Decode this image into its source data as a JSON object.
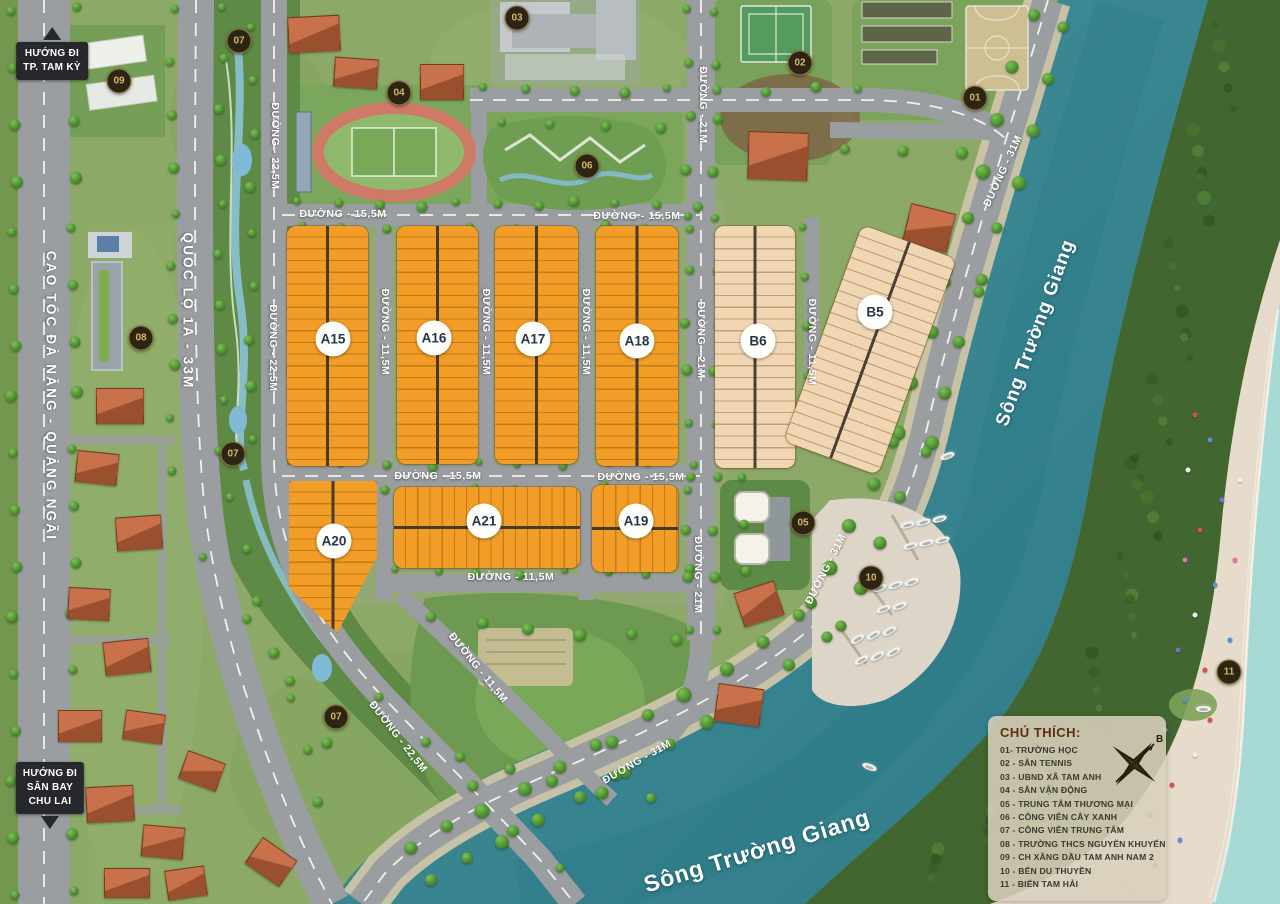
{
  "palette": {
    "base": "#8ca968",
    "scrub": "#74974f",
    "road": "#9b9ea1",
    "roadTan": "#cfc5a8",
    "river1": "#44929c",
    "river2": "#2e7a87",
    "forest": "#41662f",
    "beach": "#e7dccb",
    "sea": "#a7d9d5",
    "parkDark": "#5f8a46",
    "lawn": "#7ba75c",
    "orange": "#f29d27",
    "beige": "#f1d6b4",
    "markerBg": "#2c2414",
    "markerGold": "#d9b761",
    "badgeText": "#253648",
    "signBg": "#26282c"
  },
  "signs": [
    {
      "lines": "HƯỚNG ĐI\nTP. TAM KỲ",
      "x": 52,
      "y": 27,
      "arrow": "up"
    },
    {
      "lines": "HƯỚNG ĐI\nSÂN BAY\nCHU LAI",
      "x": 50,
      "y": 762,
      "arrow": "down"
    }
  ],
  "road_labels": [
    {
      "t": "CAO TỐC ĐÀ NẴNG - QUẢNG NGÃI",
      "x": 51,
      "y": 396,
      "r": 90,
      "big": true
    },
    {
      "t": "QUỐC LỘ 1A - 33M",
      "x": 188,
      "y": 311,
      "r": 90,
      "big": true
    },
    {
      "t": "ĐƯỜNG - 15,5M",
      "x": 343,
      "y": 214,
      "r": 0
    },
    {
      "t": "ĐƯỜNG - 15,5M",
      "x": 637,
      "y": 216,
      "r": 0
    },
    {
      "t": "ĐƯỜNG - 15,5M",
      "x": 438,
      "y": 476,
      "r": 0
    },
    {
      "t": "ĐƯỜNG - 15,5M",
      "x": 641,
      "y": 477,
      "r": 0
    },
    {
      "t": "ĐƯỜNG - 11,5M",
      "x": 511,
      "y": 577,
      "r": 0
    },
    {
      "t": "ĐƯỜNG - 11,5M",
      "x": 385,
      "y": 332,
      "r": 90
    },
    {
      "t": "ĐƯỜNG - 11,5M",
      "x": 486,
      "y": 332,
      "r": 90
    },
    {
      "t": "ĐƯỜNG - 11,5M",
      "x": 586,
      "y": 332,
      "r": 90
    },
    {
      "t": "ĐƯỜNG - 11,5M",
      "x": 812,
      "y": 342,
      "r": 90
    },
    {
      "t": "ĐƯỜNG - 21M",
      "x": 703,
      "y": 105,
      "r": 90
    },
    {
      "t": "ĐƯỜNG - 21M",
      "x": 701,
      "y": 340,
      "r": 90
    },
    {
      "t": "ĐƯỜNG - 21M",
      "x": 698,
      "y": 575,
      "r": 90
    },
    {
      "t": "ĐƯỜNG - 22,5M",
      "x": 275,
      "y": 146,
      "r": 90
    },
    {
      "t": "ĐƯỜNG - 22,5M",
      "x": 273,
      "y": 348,
      "r": 90
    },
    {
      "t": "ĐƯỜNG - 22,5M",
      "x": 398,
      "y": 737,
      "r": 52
    },
    {
      "t": "ĐƯỜNG - 11,5M",
      "x": 478,
      "y": 668,
      "r": 51
    },
    {
      "t": "ĐƯỜNG - 31M",
      "x": 1003,
      "y": 171,
      "r": -65
    },
    {
      "t": "ĐƯỜNG - 31M",
      "x": 826,
      "y": 569,
      "r": -63
    },
    {
      "t": "ĐƯỜNG - 31M",
      "x": 637,
      "y": 762,
      "r": -30
    }
  ],
  "river_labels": [
    {
      "t": "Sông Trường Giang",
      "x": 1036,
      "y": 333,
      "r": -70,
      "size": 19
    },
    {
      "t": "Sông Trường Giang",
      "x": 757,
      "y": 851,
      "r": -17,
      "size": 23
    }
  ],
  "markers": [
    {
      "n": "01",
      "x": 975,
      "y": 98
    },
    {
      "n": "02",
      "x": 800,
      "y": 63
    },
    {
      "n": "03",
      "x": 517,
      "y": 18
    },
    {
      "n": "04",
      "x": 399,
      "y": 93
    },
    {
      "n": "05",
      "x": 803,
      "y": 523
    },
    {
      "n": "06",
      "x": 587,
      "y": 166
    },
    {
      "n": "07",
      "x": 239,
      "y": 41
    },
    {
      "n": "07",
      "x": 233,
      "y": 454
    },
    {
      "n": "07",
      "x": 336,
      "y": 717
    },
    {
      "n": "08",
      "x": 141,
      "y": 338
    },
    {
      "n": "09",
      "x": 119,
      "y": 81
    },
    {
      "n": "10",
      "x": 871,
      "y": 578
    },
    {
      "n": "11",
      "x": 1229,
      "y": 672
    }
  ],
  "blocks": [
    {
      "label": "A15",
      "x": 287,
      "y": 226,
      "w": 81,
      "h": 240,
      "color": "orange",
      "dir": "h",
      "badge": [
        333,
        339
      ]
    },
    {
      "label": "A16",
      "x": 397,
      "y": 226,
      "w": 81,
      "h": 238,
      "color": "orange",
      "dir": "h",
      "badge": [
        434,
        338
      ]
    },
    {
      "label": "A17",
      "x": 495,
      "y": 226,
      "w": 83,
      "h": 238,
      "color": "orange",
      "dir": "h",
      "badge": [
        533,
        339
      ]
    },
    {
      "label": "A18",
      "x": 596,
      "y": 226,
      "w": 82,
      "h": 240,
      "color": "orange",
      "dir": "h",
      "badge": [
        637,
        341
      ]
    },
    {
      "label": "B6",
      "x": 715,
      "y": 226,
      "w": 80,
      "h": 242,
      "color": "beige",
      "dir": "h",
      "badge": [
        758,
        341
      ]
    },
    {
      "label": "B5",
      "x": 820,
      "y": 235,
      "w": 100,
      "h": 230,
      "color": "beige",
      "dir": "h",
      "rot": 20,
      "badge": [
        875,
        312
      ]
    },
    {
      "label": "A20",
      "x": 289,
      "y": 481,
      "w": 88,
      "h": 152,
      "color": "orange",
      "dir": "h",
      "clip": "polygon(0 0,100% 0,100% 50%,55% 100%,0 70%)",
      "badge": [
        334,
        541
      ]
    },
    {
      "label": "A21",
      "x": 394,
      "y": 487,
      "w": 186,
      "h": 81,
      "color": "orange",
      "dir": "v",
      "badge": [
        484,
        521
      ]
    },
    {
      "label": "A19",
      "x": 592,
      "y": 485,
      "w": 86,
      "h": 87,
      "color": "orange",
      "dir": "v",
      "badge": [
        636,
        521
      ]
    }
  ],
  "legend": {
    "title": "CHÚ THÍCH:",
    "items": [
      "01- TRƯỜNG HỌC",
      "02 - SÂN TENNIS",
      "03 - UBND XÃ TAM ANH",
      "04 - SÂN VẬN ĐỘNG",
      "05 - TRUNG TÂM THƯƠNG MẠI",
      "06 - CÔNG VIÊN CÂY XANH",
      "07 - CÔNG VIÊN TRUNG TÂM",
      "08 - TRƯỜNG THCS NGUYỄN KHUYẾN",
      "09 - CH XĂNG DẦU TAM ANH NAM 2",
      "10 - BẾN DU THUYỀN",
      "11 - BIỂN TAM HẢI"
    ]
  },
  "compass": {
    "north_label": "B"
  },
  "tree_lines": [
    {
      "x1": 14,
      "y1": 14,
      "x2": 14,
      "y2": 894,
      "n": 17,
      "s": 10
    },
    {
      "x1": 74,
      "y1": 10,
      "x2": 74,
      "y2": 890,
      "n": 17,
      "s": 10
    },
    {
      "x1": 173,
      "y1": 12,
      "x2": 173,
      "y2": 470,
      "n": 10,
      "s": 9
    },
    {
      "x1": 221,
      "y1": 10,
      "x2": 221,
      "y2": 450,
      "n": 10,
      "s": 9
    },
    {
      "x1": 230,
      "y1": 500,
      "x2": 320,
      "y2": 800,
      "n": 7,
      "s": 9
    },
    {
      "x1": 252,
      "y1": 30,
      "x2": 252,
      "y2": 440,
      "n": 9,
      "s": 9
    },
    {
      "x1": 295,
      "y1": 235,
      "x2": 295,
      "y2": 455,
      "n": 6,
      "s": 9
    },
    {
      "x1": 300,
      "y1": 204,
      "x2": 695,
      "y2": 204,
      "n": 11,
      "s": 9
    },
    {
      "x1": 300,
      "y1": 228,
      "x2": 690,
      "y2": 228,
      "n": 10,
      "s": 8
    },
    {
      "x1": 300,
      "y1": 464,
      "x2": 695,
      "y2": 464,
      "n": 10,
      "s": 8
    },
    {
      "x1": 300,
      "y1": 489,
      "x2": 690,
      "y2": 489,
      "n": 10,
      "s": 8
    },
    {
      "x1": 395,
      "y1": 572,
      "x2": 690,
      "y2": 572,
      "n": 8,
      "s": 8
    },
    {
      "x1": 688,
      "y1": 12,
      "x2": 688,
      "y2": 630,
      "n": 13,
      "s": 9
    },
    {
      "x1": 716,
      "y1": 15,
      "x2": 716,
      "y2": 630,
      "n": 13,
      "s": 9
    },
    {
      "x1": 806,
      "y1": 230,
      "x2": 806,
      "y2": 420,
      "n": 5,
      "s": 8
    },
    {
      "x1": 480,
      "y1": 90,
      "x2": 860,
      "y2": 90,
      "n": 9,
      "s": 9
    },
    {
      "x1": 1032,
      "y1": 18,
      "x2": 948,
      "y2": 270,
      "n": 6,
      "s": 13
    },
    {
      "x1": 944,
      "y1": 285,
      "x2": 898,
      "y2": 430,
      "n": 4,
      "s": 13
    },
    {
      "x1": 893,
      "y1": 445,
      "x2": 810,
      "y2": 605,
      "n": 5,
      "s": 13
    },
    {
      "x1": 800,
      "y1": 618,
      "x2": 610,
      "y2": 742,
      "n": 6,
      "s": 13
    },
    {
      "x1": 598,
      "y1": 748,
      "x2": 410,
      "y2": 848,
      "n": 6,
      "s": 13
    },
    {
      "x1": 1066,
      "y1": 30,
      "x2": 982,
      "y2": 280,
      "n": 6,
      "s": 12
    },
    {
      "x1": 976,
      "y1": 295,
      "x2": 930,
      "y2": 440,
      "n": 4,
      "s": 12
    },
    {
      "x1": 924,
      "y1": 455,
      "x2": 838,
      "y2": 628,
      "n": 5,
      "s": 12
    },
    {
      "x1": 826,
      "y1": 640,
      "x2": 628,
      "y2": 772,
      "n": 6,
      "s": 12
    },
    {
      "x1": 616,
      "y1": 778,
      "x2": 428,
      "y2": 880,
      "n": 6,
      "s": 12
    },
    {
      "x1": 380,
      "y1": 700,
      "x2": 560,
      "y2": 870,
      "n": 5,
      "s": 10
    },
    {
      "x1": 205,
      "y1": 560,
      "x2": 330,
      "y2": 740,
      "n": 4,
      "s": 9
    },
    {
      "x1": 745,
      "y1": 480,
      "x2": 745,
      "y2": 570,
      "n": 3,
      "s": 9
    },
    {
      "x1": 790,
      "y1": 150,
      "x2": 960,
      "y2": 150,
      "n": 4,
      "s": 10
    },
    {
      "x1": 500,
      "y1": 125,
      "x2": 660,
      "y2": 125,
      "n": 4,
      "s": 9
    },
    {
      "x1": 430,
      "y1": 620,
      "x2": 680,
      "y2": 640,
      "n": 6,
      "s": 11
    },
    {
      "x1": 460,
      "y1": 760,
      "x2": 650,
      "y2": 800,
      "n": 5,
      "s": 11
    }
  ],
  "houses": [
    {
      "x": 288,
      "y": 16,
      "w": 50,
      "h": 34,
      "r": -3
    },
    {
      "x": 334,
      "y": 58,
      "w": 42,
      "h": 28,
      "r": 4
    },
    {
      "x": 420,
      "y": 64,
      "w": 42,
      "h": 34,
      "r": 0
    },
    {
      "x": 748,
      "y": 132,
      "w": 58,
      "h": 46,
      "r": 2
    },
    {
      "x": 906,
      "y": 208,
      "w": 44,
      "h": 38,
      "r": 14
    },
    {
      "x": 738,
      "y": 586,
      "w": 40,
      "h": 34,
      "r": -18
    },
    {
      "x": 716,
      "y": 686,
      "w": 44,
      "h": 36,
      "r": 8
    },
    {
      "x": 96,
      "y": 388,
      "w": 46,
      "h": 34,
      "r": 0
    },
    {
      "x": 76,
      "y": 452,
      "w": 40,
      "h": 30,
      "r": 6
    },
    {
      "x": 116,
      "y": 516,
      "w": 44,
      "h": 32,
      "r": -4
    },
    {
      "x": 68,
      "y": 588,
      "w": 40,
      "h": 30,
      "r": 3
    },
    {
      "x": 104,
      "y": 640,
      "w": 44,
      "h": 32,
      "r": -6
    },
    {
      "x": 58,
      "y": 710,
      "w": 42,
      "h": 30,
      "r": 0
    },
    {
      "x": 124,
      "y": 712,
      "w": 38,
      "h": 28,
      "r": 8
    },
    {
      "x": 86,
      "y": 786,
      "w": 46,
      "h": 34,
      "r": -3
    },
    {
      "x": 142,
      "y": 826,
      "w": 40,
      "h": 30,
      "r": 5
    },
    {
      "x": 104,
      "y": 868,
      "w": 44,
      "h": 28,
      "r": 0
    },
    {
      "x": 166,
      "y": 868,
      "w": 38,
      "h": 28,
      "r": -8
    },
    {
      "x": 182,
      "y": 756,
      "w": 38,
      "h": 28,
      "r": 20
    },
    {
      "x": 250,
      "y": 846,
      "w": 40,
      "h": 30,
      "r": 35
    }
  ],
  "boats": [
    {
      "x": 900,
      "y": 522,
      "r": -15
    },
    {
      "x": 916,
      "y": 519,
      "r": -15
    },
    {
      "x": 932,
      "y": 516,
      "r": -15
    },
    {
      "x": 903,
      "y": 543,
      "r": -15
    },
    {
      "x": 919,
      "y": 540,
      "r": -15
    },
    {
      "x": 935,
      "y": 537,
      "r": -15
    },
    {
      "x": 872,
      "y": 585,
      "r": -20
    },
    {
      "x": 888,
      "y": 582,
      "r": -20
    },
    {
      "x": 904,
      "y": 579,
      "r": -20
    },
    {
      "x": 876,
      "y": 606,
      "r": -20
    },
    {
      "x": 892,
      "y": 603,
      "r": -20
    },
    {
      "x": 850,
      "y": 636,
      "r": -30
    },
    {
      "x": 866,
      "y": 632,
      "r": -30
    },
    {
      "x": 882,
      "y": 628,
      "r": -30
    },
    {
      "x": 854,
      "y": 657,
      "r": -30
    },
    {
      "x": 870,
      "y": 653,
      "r": -30
    },
    {
      "x": 886,
      "y": 649,
      "r": -30
    },
    {
      "x": 940,
      "y": 453,
      "r": -20
    },
    {
      "x": 862,
      "y": 764,
      "r": 20
    },
    {
      "x": 1196,
      "y": 706,
      "r": 0
    }
  ],
  "umbrellas": [
    {
      "x": 1195,
      "y": 415,
      "c": "#d94f4f"
    },
    {
      "x": 1210,
      "y": 440,
      "c": "#5a8fd9"
    },
    {
      "x": 1188,
      "y": 470,
      "c": "#f0f0f0"
    },
    {
      "x": 1222,
      "y": 500,
      "c": "#7a6fd1"
    },
    {
      "x": 1200,
      "y": 530,
      "c": "#d94f4f"
    },
    {
      "x": 1185,
      "y": 560,
      "c": "#d977b5"
    },
    {
      "x": 1215,
      "y": 585,
      "c": "#5a8fd9"
    },
    {
      "x": 1195,
      "y": 615,
      "c": "#f0f0f0"
    },
    {
      "x": 1178,
      "y": 650,
      "c": "#7a6fd1"
    },
    {
      "x": 1205,
      "y": 670,
      "c": "#d94f4f"
    },
    {
      "x": 1185,
      "y": 700,
      "c": "#5a8fd9"
    },
    {
      "x": 1165,
      "y": 730,
      "c": "#d977b5"
    },
    {
      "x": 1195,
      "y": 755,
      "c": "#f0f0f0"
    },
    {
      "x": 1172,
      "y": 785,
      "c": "#d94f4f"
    },
    {
      "x": 1150,
      "y": 815,
      "c": "#7a6fd1"
    },
    {
      "x": 1180,
      "y": 840,
      "c": "#5a8fd9"
    },
    {
      "x": 1155,
      "y": 865,
      "c": "#d94f4f"
    },
    {
      "x": 1130,
      "y": 885,
      "c": "#f0f0f0"
    },
    {
      "x": 1210,
      "y": 720,
      "c": "#d94f4f"
    },
    {
      "x": 1230,
      "y": 640,
      "c": "#5a8fd9"
    },
    {
      "x": 1235,
      "y": 560,
      "c": "#d977b5"
    },
    {
      "x": 1240,
      "y": 480,
      "c": "#f0f0f0"
    }
  ]
}
